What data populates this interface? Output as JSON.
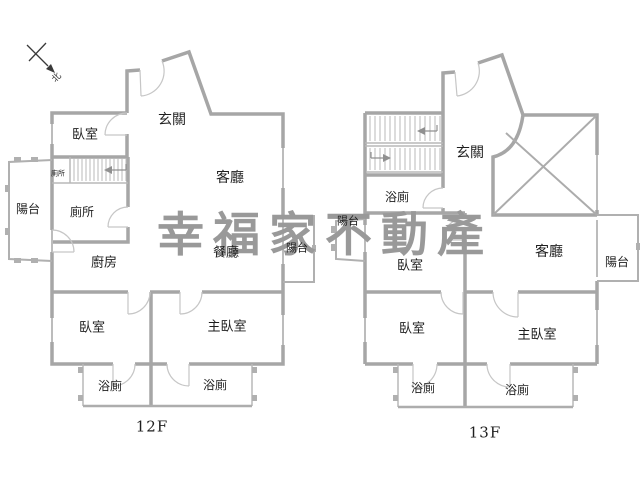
{
  "canvas": {
    "background_color": "#ffffff",
    "wall_color": "#a6a6a6",
    "thin_line_color": "#b8b8b8",
    "door_arc_color": "#c6c6c6",
    "text_color": "#1e1e1e",
    "watermark_color": "#999999"
  },
  "watermark": {
    "text": "幸福家不動產"
  },
  "compass": {
    "north_label": "北"
  },
  "floor_12f": {
    "floor_label": "12F",
    "rooms": {
      "bedroom_top": "臥室",
      "entrance": "玄關",
      "living_room": "客廳",
      "toilet_small": "廁所",
      "toilet": "廁所",
      "balcony_left": "陽台",
      "kitchen": "廚房",
      "dining_room": "餐廳",
      "balcony_right": "陽台",
      "bedroom_left": "臥室",
      "master_bedroom": "主臥室",
      "bathroom_left": "浴廁",
      "bathroom_right": "浴廁"
    }
  },
  "floor_13f": {
    "floor_label": "13F",
    "rooms": {
      "bathroom_top": "浴廁",
      "entrance": "玄關",
      "balcony_left": "陽台",
      "bedroom_top": "臥室",
      "living_room": "客廳",
      "balcony_right": "陽台",
      "bedroom_left": "臥室",
      "master_bedroom": "主臥室",
      "bathroom_left": "浴廁",
      "bathroom_right": "浴廁"
    }
  }
}
